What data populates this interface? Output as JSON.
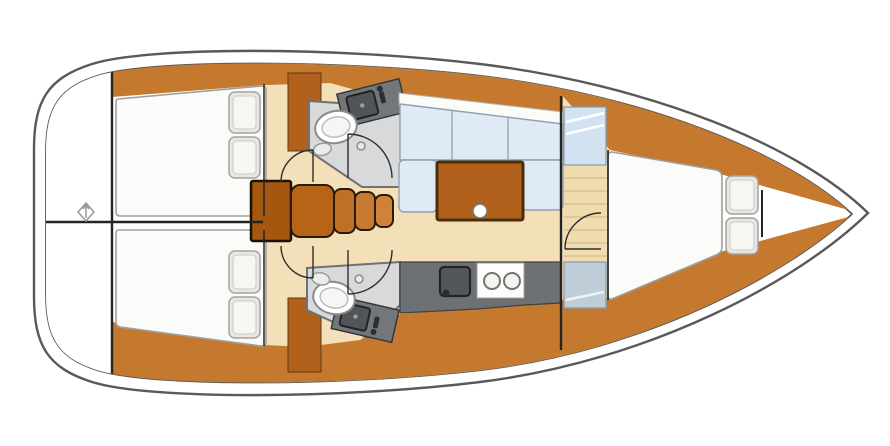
{
  "diagram": {
    "kind": "sailboat-interior-floor-plan",
    "orientation": {
      "bow": "right",
      "stern": "left"
    }
  },
  "colors": {
    "hull_line": "#59595b",
    "wall": "#242422",
    "white": "#ffffff",
    "wood": "#c5792f",
    "wood_mid": "#b2611c",
    "wood_dark": "#a4570e",
    "step1": "#b66516",
    "step2": "#c07026",
    "step3": "#c87a31",
    "step4": "#cf8238",
    "floor": "#f3e0b8",
    "floor_plank": "#d8bc8a",
    "bed": "#fbfbf9",
    "pillow": "#e9e7e3",
    "pillow_inner": "#f7f6f3",
    "settee": "#dfeaf5",
    "settee_edge": "#90a1b1",
    "backrest": "#fbfbf8",
    "counter": "#6d7174",
    "appliance": "#53575a",
    "stove_panel": "#fdfdfb",
    "head_floor": "#d7d9da",
    "locker": "#d3e2f0",
    "locker_aft": "#bfcdd9",
    "toilet": "#ffffff"
  },
  "rooms": {
    "stern_platform": {
      "marker": "windlass-diamond"
    },
    "aft_cabin_port": {
      "berth": "double",
      "pillows": 2
    },
    "aft_cabin_starboard": {
      "berth": "double",
      "pillows": 2
    },
    "head_port": {
      "fixtures": [
        "toilet",
        "sink-vanity"
      ]
    },
    "head_starboard": {
      "fixtures": [
        "toilet",
        "sink-vanity"
      ]
    },
    "companionway": {
      "steps": 5
    },
    "saloon": {
      "settee": "U-shaped",
      "bench_segments": 3,
      "table": 1,
      "cup_holder": 1
    },
    "galley": {
      "sink": 1,
      "burners": 2
    },
    "forward_cabin": {
      "berth": "V-berth",
      "pillows": 2,
      "hanging_lockers": 2,
      "sole": "planked"
    }
  }
}
